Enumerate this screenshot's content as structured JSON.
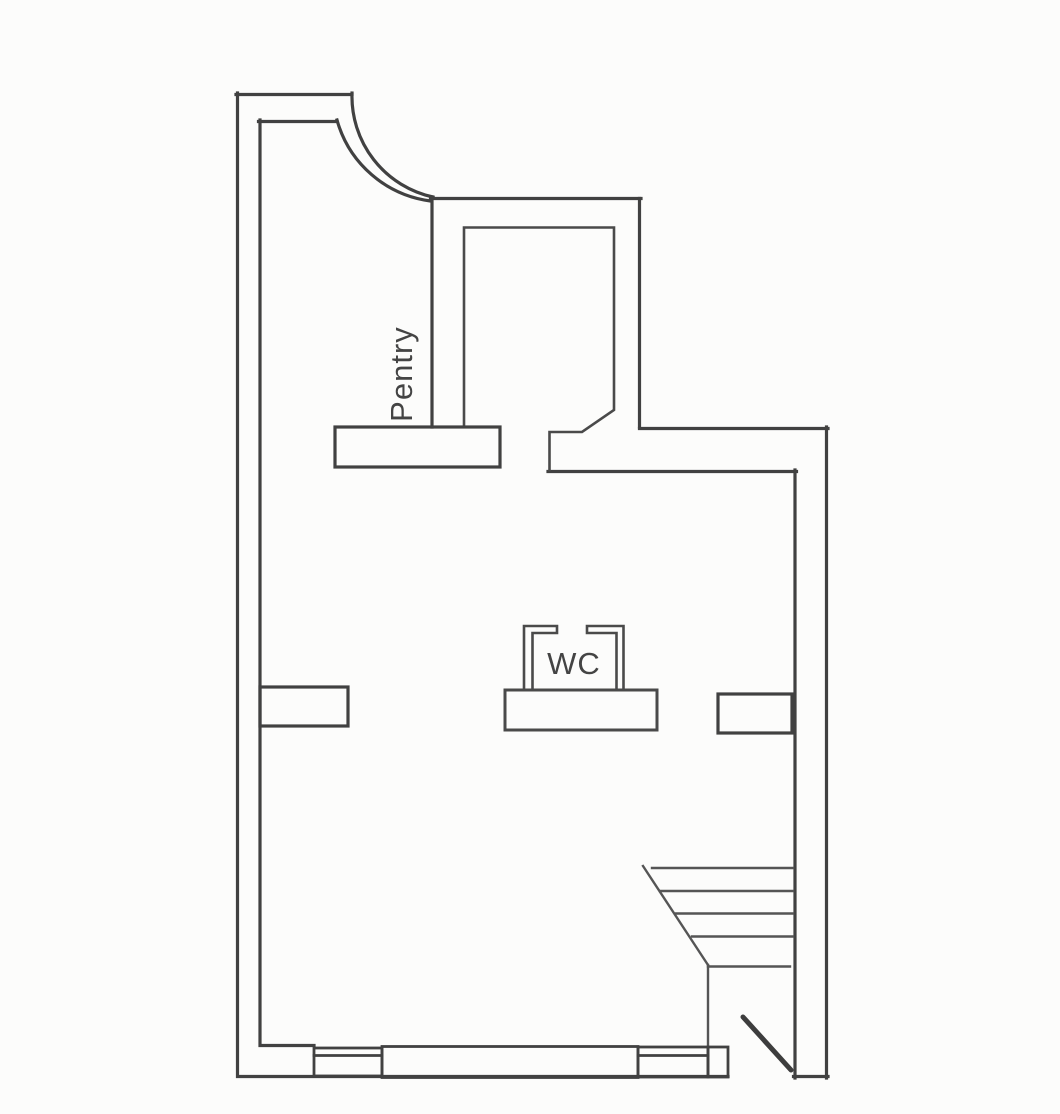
{
  "page": {
    "background": "#fcfcfb",
    "type_label": "scanned floor plan drawing"
  },
  "plan": {
    "labels": {
      "pantry": "Pentry",
      "wc": "WC"
    },
    "colors": {
      "wall": "#414141",
      "thin": "#4a4a4a",
      "stair": "#555555",
      "door": "#3d3d3d",
      "text": "#444444"
    },
    "counts": {
      "stair_treads": 5,
      "window_symbols": 2
    }
  }
}
